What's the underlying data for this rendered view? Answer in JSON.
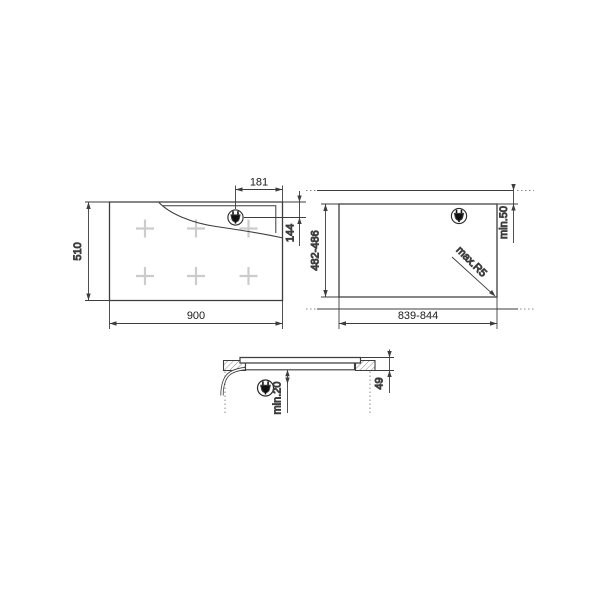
{
  "drawing": {
    "type": "hob-installation-dimensions",
    "views": {
      "top": {
        "name": "hob top view",
        "width": "900",
        "depth": "510",
        "plug_from_right": "181",
        "plug_from_top": "144",
        "burner_count": 6
      },
      "cutout": {
        "name": "worktop cutout plan",
        "width": "839-844",
        "depth": "482-486",
        "rear_clearance": "min.50",
        "corner_radius": "max.R5"
      },
      "section": {
        "name": "worktop cross section",
        "clearance_below": "min.20",
        "built_in_depth": "49"
      }
    },
    "icons": {
      "plug": "power-plug"
    },
    "colors": {
      "line": "#3d3d3d",
      "cross": "#cccccc",
      "hatch": "#8a8a8a",
      "text": "#1a1a1a",
      "background": "#ffffff"
    }
  }
}
